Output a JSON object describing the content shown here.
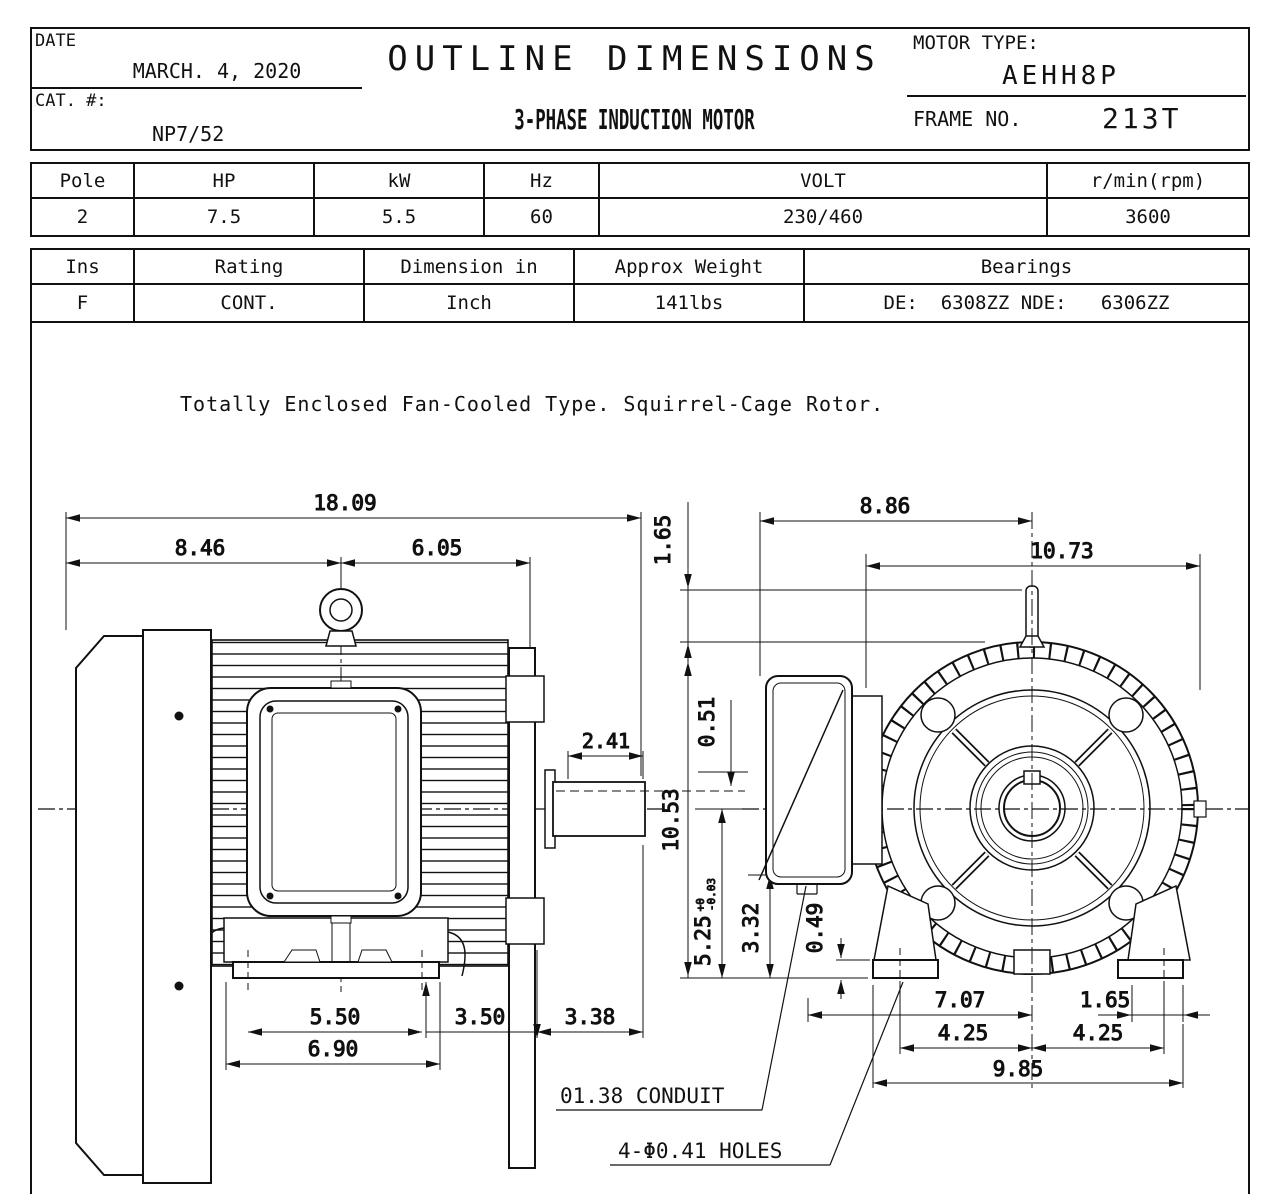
{
  "header": {
    "date_label": "DATE",
    "date_value": "MARCH. 4, 2020",
    "cat_label": "CAT. #:",
    "cat_value": "NP7/52",
    "title": "OUTLINE DIMENSIONS",
    "subtitle": "3-PHASE INDUCTION MOTOR",
    "motor_type_label": "MOTOR TYPE:",
    "motor_type_value": "AEHH8P",
    "frame_label": "FRAME NO.",
    "frame_value": "213T"
  },
  "spec_table": {
    "headers": [
      "Pole",
      "HP",
      "kW",
      "Hz",
      "VOLT",
      "r/min(rpm)"
    ],
    "values": [
      "2",
      "7.5",
      "5.5",
      "60",
      "230/460",
      "3600"
    ]
  },
  "info_table": {
    "headers": [
      "Ins",
      "Rating",
      "Dimension in",
      "Approx Weight",
      "Bearings"
    ],
    "values": [
      "F",
      "CONT.",
      "Inch",
      "141lbs",
      "DE:  6308ZZ NDE:   6306ZZ"
    ]
  },
  "note": "Totally Enclosed Fan-Cooled Type. Squirrel-Cage Rotor.",
  "dims": {
    "overall_length": "18.09",
    "rear_to_eyebolt": "8.46",
    "eyebolt_to_face": "6.05",
    "shaft_extension": "2.41",
    "foot_hole_span": "5.50",
    "foot_length": "6.90",
    "face_to_pad": "3.50",
    "shaft_length": "3.38",
    "eyebolt_height": "1.65",
    "frame_height": "10.53",
    "key_height": "0.51",
    "shaft_center_height": "5.25",
    "shaft_center_tol_upper": "+0",
    "shaft_center_tol_lower": "-0.03",
    "conduit_center_height": "3.32",
    "foot_pad_thickness": "0.49",
    "box_to_center": "8.86",
    "frame_od": "10.73",
    "conduit_to_center": "7.07",
    "pad_edge": "1.65",
    "bolt_span_left": "4.25",
    "bolt_span_right": "4.25",
    "base_width": "9.85"
  },
  "callouts": {
    "conduit": "01.38 CONDUIT",
    "holes": "4-Φ0.41 HOLES"
  }
}
